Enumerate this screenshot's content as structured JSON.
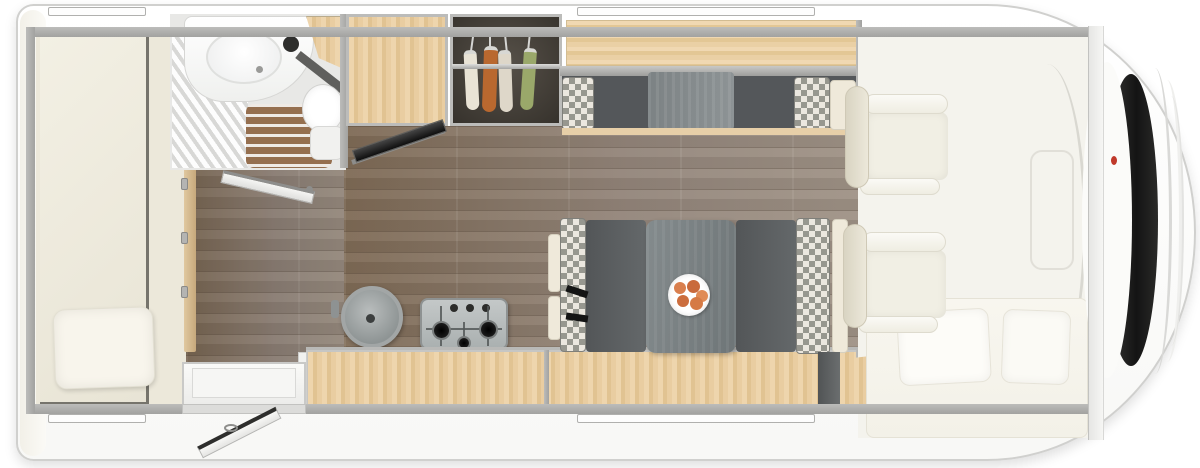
{
  "meta": {
    "label": "Motorhome floor plan — top-down interior view",
    "type": "floorplan"
  },
  "colors": {
    "body": "#ffffff",
    "wall": "#a9a9a7",
    "wood_cabinet": "#e6cda6",
    "wood_floor": "#8d7a67",
    "counter": "#64686a",
    "seat_dark": "#56595a",
    "check_dark": "#97978f",
    "check_light": "#ebe7df",
    "cream_upholstery": "#f1efe4",
    "windshield": "#1a1a18",
    "accent_red": "#c0392b"
  },
  "zones": {
    "rear_bedroom": {
      "label": "Rear bedroom — longitudinal bed with pillow"
    },
    "bathroom": {
      "label": "Washroom — shower, washbasin and toilet"
    },
    "bathroom_door": {
      "label": "Washroom door shown open"
    },
    "wardrobe": {
      "label": "Wardrobe with clothes on hangers",
      "garments": [
        {
          "name": "garment-white",
          "color": "#e9e3d5"
        },
        {
          "name": "garment-orange",
          "color": "#b9682f"
        },
        {
          "name": "garment-cream",
          "color": "#ded7c9"
        },
        {
          "name": "garment-green",
          "color": "#9aa86a"
        }
      ]
    },
    "tv": {
      "label": "Flat-screen TV on swivel bracket"
    },
    "kitchen": {
      "label": "Kitchen — round sink and gas hob",
      "burners": 3,
      "control_knobs": 3
    },
    "overhead_locker": {
      "label": "Overhead locker above front bench"
    },
    "front_bench": {
      "label": "Forward bench with checked cushions"
    },
    "dinette": {
      "label": "Half-dinette — facing bench seats with table",
      "plate": {
        "label": "Plate of food on table",
        "food_colors": [
          "#d97f4e",
          "#c96a3c",
          "#e08b55",
          "#cc6e3e",
          "#d57a45"
        ]
      },
      "seat_belts": 2
    },
    "sideboard": {
      "label": "Low sideboard along entrance wall"
    },
    "cab": {
      "label": "Driver cab — two swivel seats and drop-down bed",
      "seats": 2,
      "pillows": 2
    },
    "entry": {
      "label": "Entrance door shown open with step"
    },
    "windows": {
      "label": "Window openings",
      "count": 4
    }
  }
}
